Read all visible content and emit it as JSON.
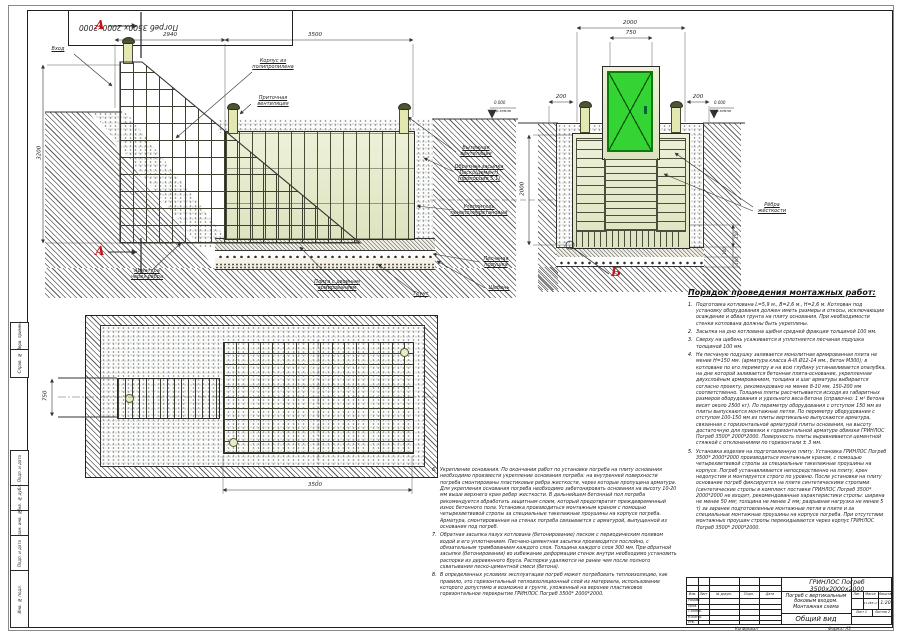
{
  "page": {
    "stamp_rotated": "Погреб 3500х 2000х2000",
    "copied_label": "Копировал",
    "format_label": "Формат А3"
  },
  "margin_boxes": {
    "b1": "Перв. примен.",
    "b2": "Справ. №",
    "b3": "Подп. и дата",
    "b4": "Инв. № дубл.",
    "b5": "Взам. инв. №",
    "b6": "Подп. и дата",
    "b7": "Инв. № подл."
  },
  "sectionA": {
    "marker": "А",
    "dims": {
      "d2940": "2940",
      "d3500": "3500",
      "d3200": "3200",
      "d2000": "2000"
    },
    "elevation": {
      "value": "0.000",
      "ref": "ур.земли"
    },
    "labels": {
      "entry": "Вход",
      "body": "Корпус из полипропилена",
      "supply_vent": "Приточная вентиляция",
      "exhaust_vent": "Вытяжная вентиляция",
      "backfill": "Обратная засыпка Песко(цемент) (пропорция 5:1)",
      "insulation": "Утеплитель пенополиуретановый",
      "sand": "Песчаная подушка",
      "gravel": "Щебень",
      "soil": "Грунт",
      "slab": "Плита с двойным армированием",
      "rebar": "Арматура через рёбра"
    }
  },
  "sectionB": {
    "marker": "Б",
    "dims": {
      "d2000": "2000",
      "d750": "750",
      "d200l": "200",
      "d200r": "200",
      "d150": "150",
      "d100a": "100",
      "d100b": "100"
    },
    "elevation": {
      "value": "0.000",
      "ref": "ур.земли"
    },
    "labels": {
      "ribs": "Рёбра жёсткости"
    }
  },
  "plan": {
    "dims": {
      "d3500": "3500",
      "d750": "750"
    }
  },
  "mounting": {
    "title": "Порядок проведения монтажных работ:",
    "items": [
      {
        "num": "1.",
        "text": "Подготовка котлована  L=5,9 м.,  В=2,6 м.,  Н=2,6 м. Котлован под установку оборудования должен иметь размеры и откосы, исключающие осаждение и обвал грунта на плиту основания. При необходимости стенки котлована должны быть укреплены."
      },
      {
        "num": "2.",
        "text": "Засыпка на дно котлована щебня средней фракции толщиной 100 мм."
      },
      {
        "num": "3.",
        "text": "Сверху на щебень усаживается и уплотняется песчаная подушка толщиной 100 мм."
      },
      {
        "num": "4.",
        "text": "На песчаную подушку заливается монолитная армированная плита не менее Н=150 мм. (арматура класса  А-III Ø12-14 мм., бетон М300); в котловане по его периметру и на всю глубину устанавливается опалубка, на дне которой заливается бетонная плита-основание, укрепленная двухслойным армированием, толщина и шаг арматуры выбирается согласно проекту, рекомендовано не менее 8-10 мм, 150-200 мм соответственно. Толщина плиты рассчитывается исходя из габаритных размеров оборудования и удельного веса бетона (справочно: 1 м³ бетона весит около 2500 кг). По периметру оборудования с отступом 150 мм из плиты выпускаются монтажные петли. По периметру оборудования с отступом 100-150 мм из плиты вертикально выпускаются арматура, связанная с горизонтальной арматурой плиты основания, на высоту достаточную для привязки к горизонтальной арматуре обвязки ГРИНЛОС Погреб 3500*  2000*2000. Поверхность плиты выравнивается цементной стяжкой с отклонениями по горизонтали ± 3 мм."
      },
      {
        "num": "5.",
        "text": "Установка изделия на подготовленную плиту. Установка ГРИНЛОС Погреб 3500* 2000*2000 производиться монтажным краном, с помощью четырехветвевой стропы за специальные такелажные проушины на корпусе. Погреб устанавливается непосредственно на плиту, крен недопустим и монтируется строго по уровню. После установки на плиту основание погреб фиксируется на плите синтетическими стропами (синтетические стропы в комплект поставки ГРИНЛОС Погреб 3500*  2000*2000 не входят, рекомендованные характеристики стропы: ширина не менее 50 мм; толщина не менее 2 мм; разрывная нагрузка не менее 5 т) за заранее подготовленные монтажные петли в плите и за специальные монтажные проушины на корпусе погреба. При отсутствии монтажных проушин стропы перекидываются через корпус ГРИНЛОС Погреб 3500*  2000*2000."
      }
    ]
  },
  "notes": {
    "items": [
      {
        "num": "6.",
        "text": "Укрепление основания. По окончании работ по установке погреба на плиту основания необходимо произвести укрепление основания погреба: на внутренней поверхности погреба смонтированы пластиковые ребра жесткости, через которые пропущена арматура. Для укрепления основания погреба необходимо забетонировать основания на высоту 10-20 мм выше верхнего края ребер жесткости. В дальнейшем бетонный пол погреба рекомендуется обработать защитным слоем, который предотвратит преждевременный износ бетонного пола. Установка производиться монтажным краном с помощью четырехветвевой стропы за специальные такелажные проушины на корпусе погреба. Арматура, смонтированная на стенах погреба связывается с арматурой, выпущенной из основания под погреб."
      },
      {
        "num": "7.",
        "text": "Обратная засыпка пазух котлована (бетонирование) песком с периодическим поливом водой и его уплотнением. Песчано-цементная засыпка производится послойно, с обязательным трамбованием каждого слоя. Толщина каждого слоя 300 мм. При обратной засыпке (бетонировании) во избежание деформации стенок внутри необходимо установить распорки из деревянного бруса. Распорки удаляются не ранее чем после полного схватывания песко-цементной смеси (бетона)."
      },
      {
        "num": "8.",
        "text": "В определенных условиях эксплуатации погреб может потребовать теплоизоляцию, как правило, это горизонтальный теплоизоляционный слой из материала, использование которого допустимо и возможно в грунте, уложенный на верхнее пластиковое горизонтальное перекрытие ГРИНЛОС Погреб 3500*  2000*2000."
      }
    ]
  },
  "titleblock": {
    "product": "ГРИНЛОС Погреб 3500х2000х2000",
    "description": "Погреб с вертикальным боковым входом. Монтажная схема",
    "view": "Общий вид",
    "scale": "1:20",
    "mass": "11.285 кг",
    "headers": {
      "izm": "Изм.",
      "list": "Лист",
      "doc": "№ докум.",
      "sign": "Подп.",
      "date": "Дата",
      "lit": "Лит.",
      "mass": "Масса",
      "scale": "Масштаб"
    },
    "rows": {
      "dev": "Разраб.",
      "check": "Пров.",
      "tcontr": "Т.контр.",
      "ncontr": "Н.контр.",
      "approve": "Утв."
    },
    "sheet_label": "Лист",
    "sheet_no": "1",
    "sheets_label": "Листов",
    "sheets_total": "2"
  }
}
